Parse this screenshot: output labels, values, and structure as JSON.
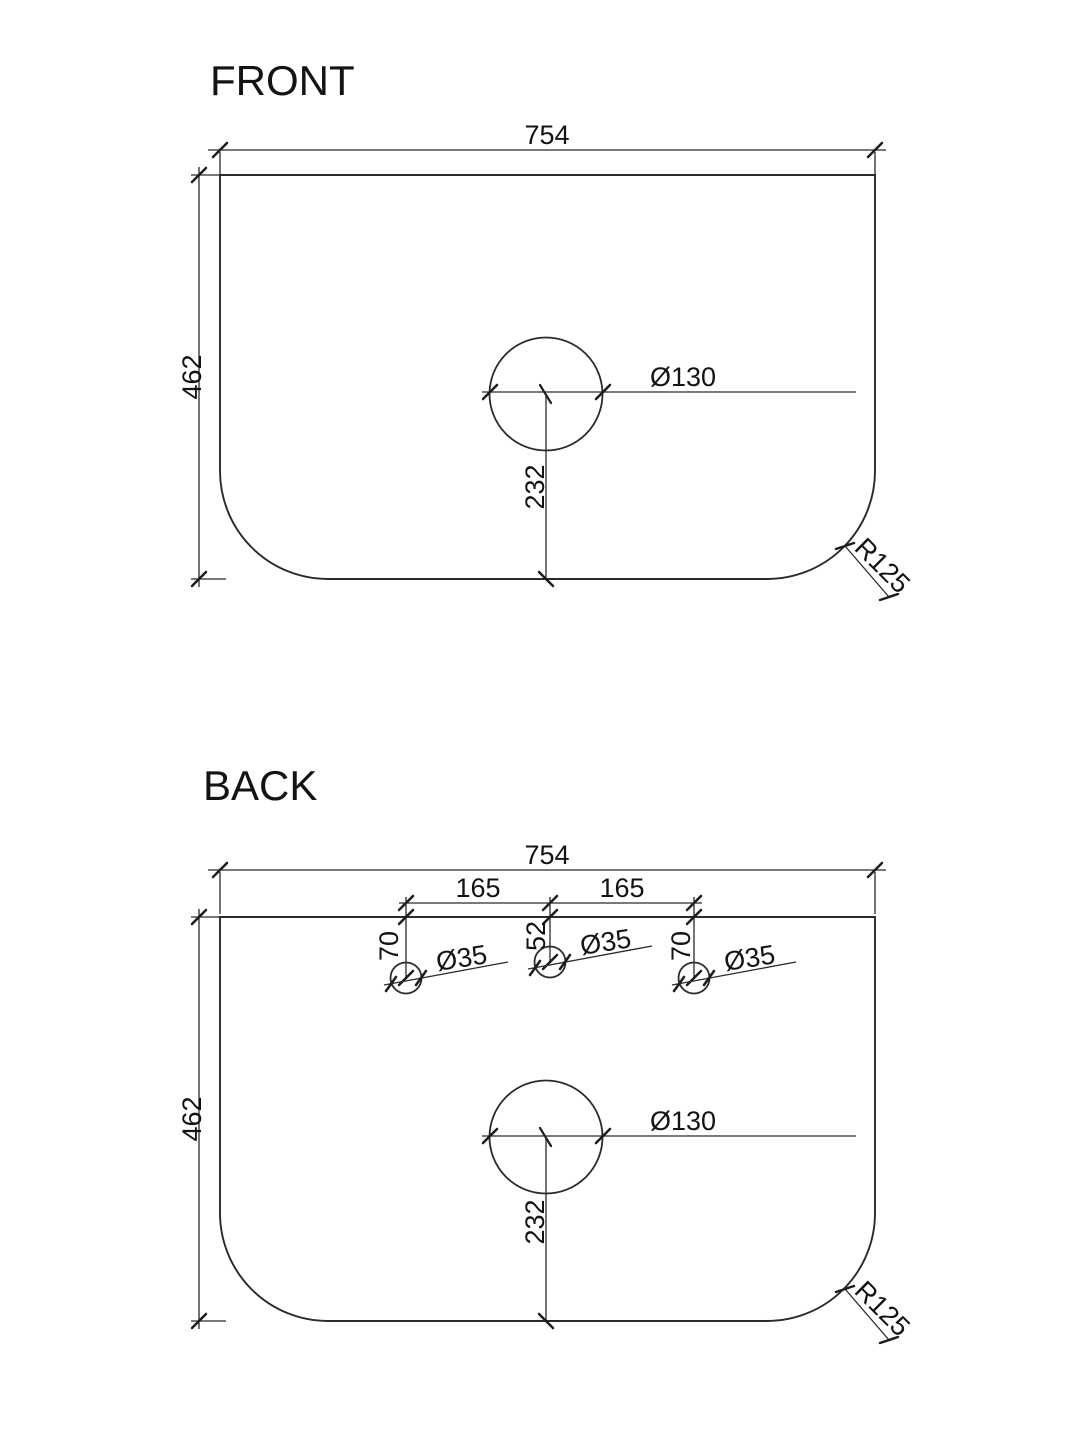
{
  "views": {
    "front": {
      "title": "FRONT",
      "dims": {
        "width": "754",
        "height": "462",
        "basin_hole_diameter": "Ø130",
        "basin_hole_offset_from_bottom": "232",
        "corner_radius": "R125"
      }
    },
    "back": {
      "title": "BACK",
      "dims": {
        "width": "754",
        "height": "462",
        "tap_spacing_left": "165",
        "tap_spacing_right": "165",
        "tap_offset_left": "70",
        "tap_offset_center": "52",
        "tap_offset_right": "70",
        "tap_hole_diameter_left": "Ø35",
        "tap_hole_diameter_center": "Ø35",
        "tap_hole_diameter_right": "Ø35",
        "basin_hole_diameter": "Ø130",
        "basin_hole_offset_from_bottom": "232",
        "corner_radius": "R125"
      }
    }
  },
  "style": {
    "line_color": "#2a2a2a",
    "text_color": "#131313",
    "background": "#ffffff"
  }
}
